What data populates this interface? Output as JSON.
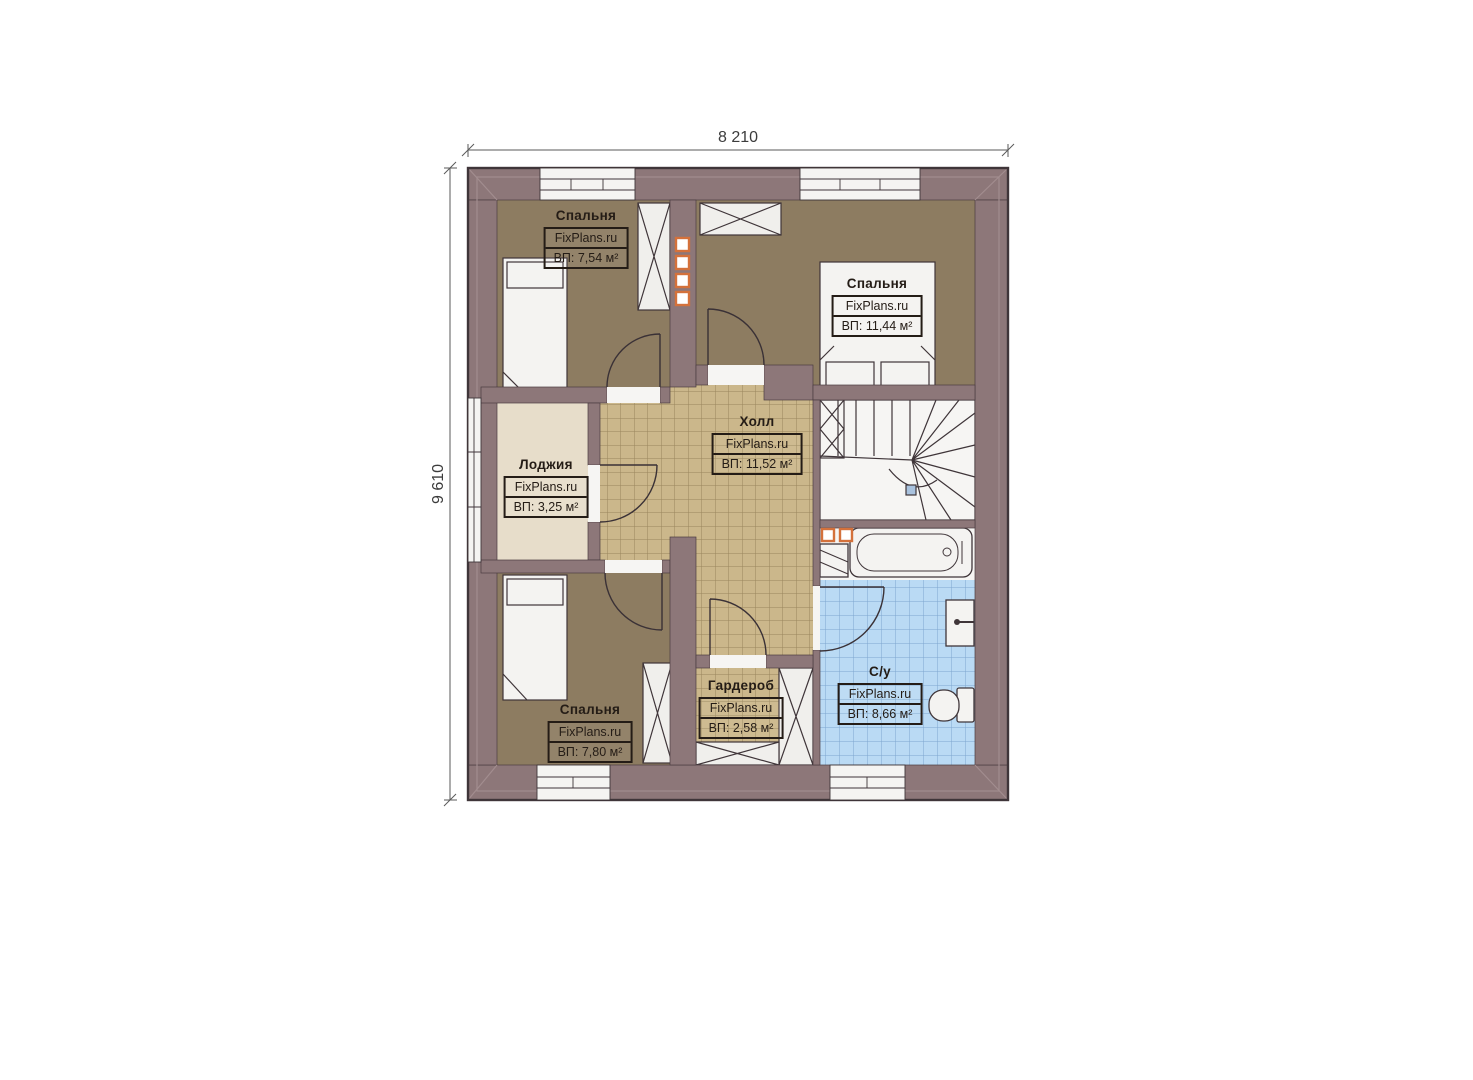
{
  "plan": {
    "dimension_width": "8 210",
    "dimension_height": "9 610",
    "rooms": [
      {
        "key": "bedroom-top-left",
        "name": "Спальня",
        "site": "FixPlans.ru",
        "area": "ВП: 7,54 м²"
      },
      {
        "key": "bedroom-top-right",
        "name": "Спальня",
        "site": "FixPlans.ru",
        "area": "ВП: 11,44 м²"
      },
      {
        "key": "hall",
        "name": "Холл",
        "site": "FixPlans.ru",
        "area": "ВП: 11,52 м²"
      },
      {
        "key": "loggia",
        "name": "Лоджия",
        "site": "FixPlans.ru",
        "area": "ВП: 3,25 м²"
      },
      {
        "key": "bedroom-bottom-left",
        "name": "Спальня",
        "site": "FixPlans.ru",
        "area": "ВП: 7,80 м²"
      },
      {
        "key": "wardrobe",
        "name": "Гардероб",
        "site": "FixPlans.ru",
        "area": "ВП: 2,58 м²"
      },
      {
        "key": "bathroom",
        "name": "С/у",
        "site": "FixPlans.ru",
        "area": "ВП: 8,66 м²"
      }
    ],
    "colors": {
      "wall": "#8d7779",
      "bedroom_floor": "#8d7c61",
      "hall_tile": "#cbb78b",
      "loggia_floor": "#e7ddca",
      "bathroom_tile": "#badaf4",
      "vent_accent": "#d4713b",
      "outline": "#3f3539"
    }
  }
}
